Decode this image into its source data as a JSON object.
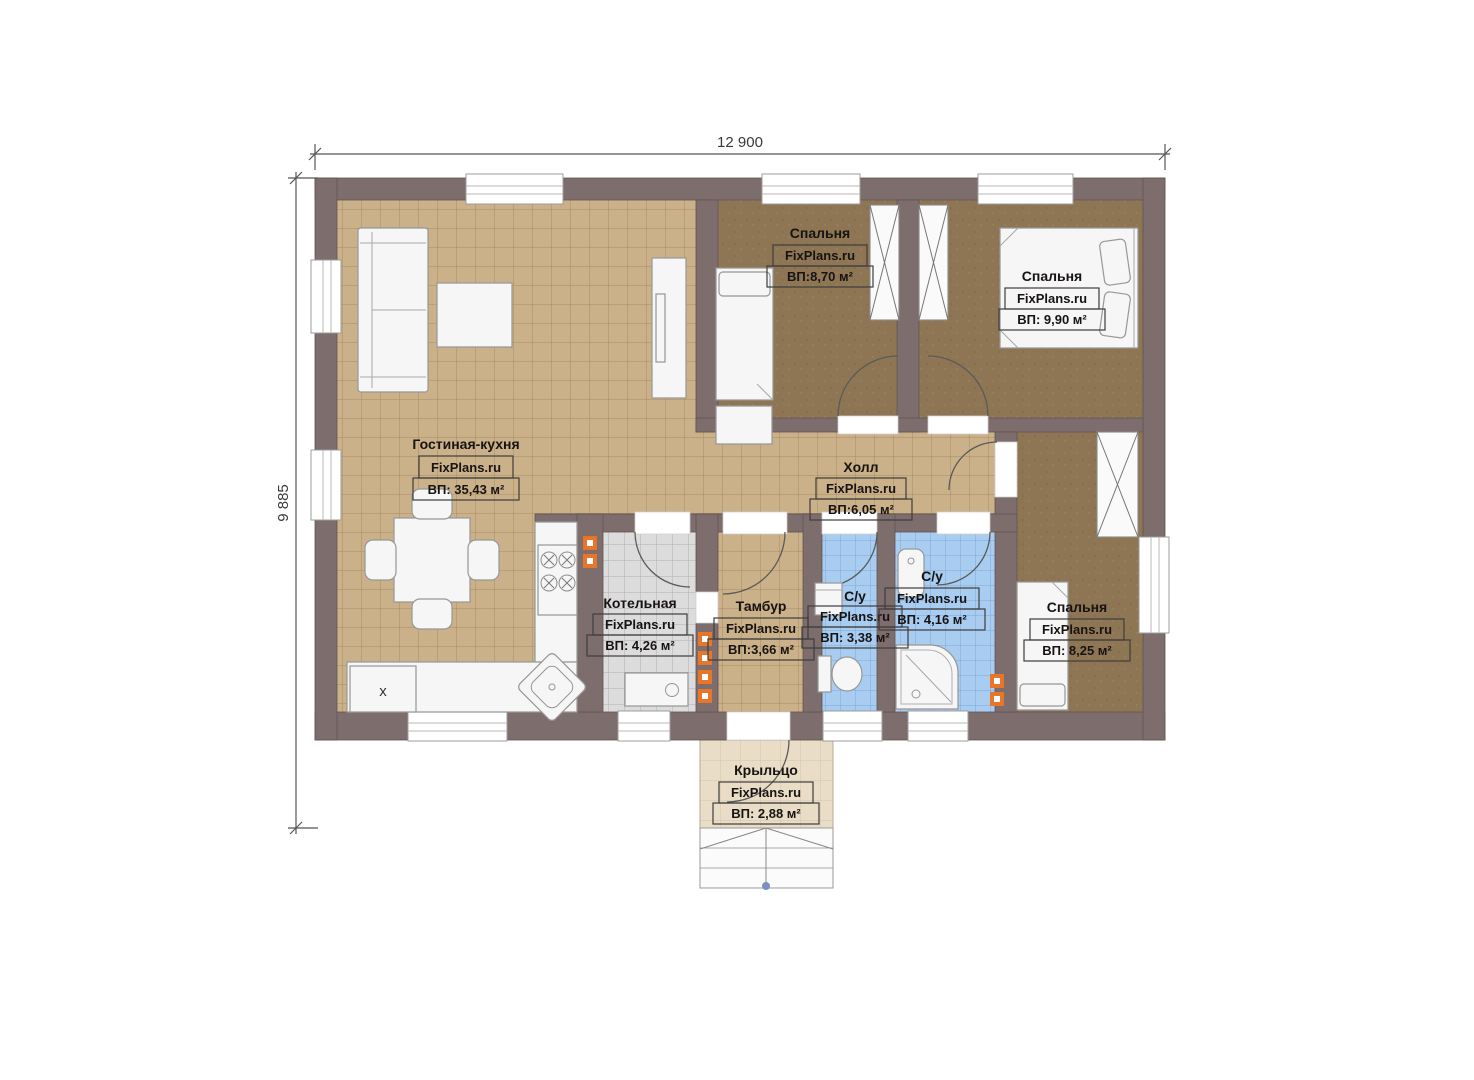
{
  "plan": {
    "brand": "FixPlans.ru",
    "dimensions": {
      "width_label": "12 900",
      "height_label": "9 885"
    },
    "rooms": [
      {
        "id": "living-kitchen",
        "name": "Гостиная-кухня",
        "area": "ВП: 35,43 м²"
      },
      {
        "id": "bedroom-1",
        "name": "Спальня",
        "area": "ВП:8,70 м²"
      },
      {
        "id": "bedroom-2",
        "name": "Спальня",
        "area": "ВП: 9,90 м²"
      },
      {
        "id": "hall",
        "name": "Холл",
        "area": "ВП:6,05 м²"
      },
      {
        "id": "boiler-room",
        "name": "Котельная",
        "area": "ВП: 4,26 м²"
      },
      {
        "id": "vestibule",
        "name": "Тамбур",
        "area": "ВП:3,66 м²"
      },
      {
        "id": "bathroom-1",
        "name": "С/у",
        "area": "ВП: 3,38 м²"
      },
      {
        "id": "bathroom-2",
        "name": "С/у",
        "area": "ВП: 4,16 м²"
      },
      {
        "id": "bedroom-3",
        "name": "Спальня",
        "area": "ВП: 8,25 м²"
      },
      {
        "id": "porch",
        "name": "Крыльцо",
        "area": "ВП: 2,88 м²"
      }
    ],
    "kitchen": {
      "fridge_marker": "x"
    },
    "colors": {
      "wall": "#7e6d6d",
      "floor_living": "#cbb189",
      "floor_bedroom": "#8e7655",
      "floor_boiler": "#dcdcdc",
      "floor_bath": "#a9cdf1",
      "floor_porch": "#e9ddc7",
      "vent_marker": "#e8762a"
    }
  }
}
